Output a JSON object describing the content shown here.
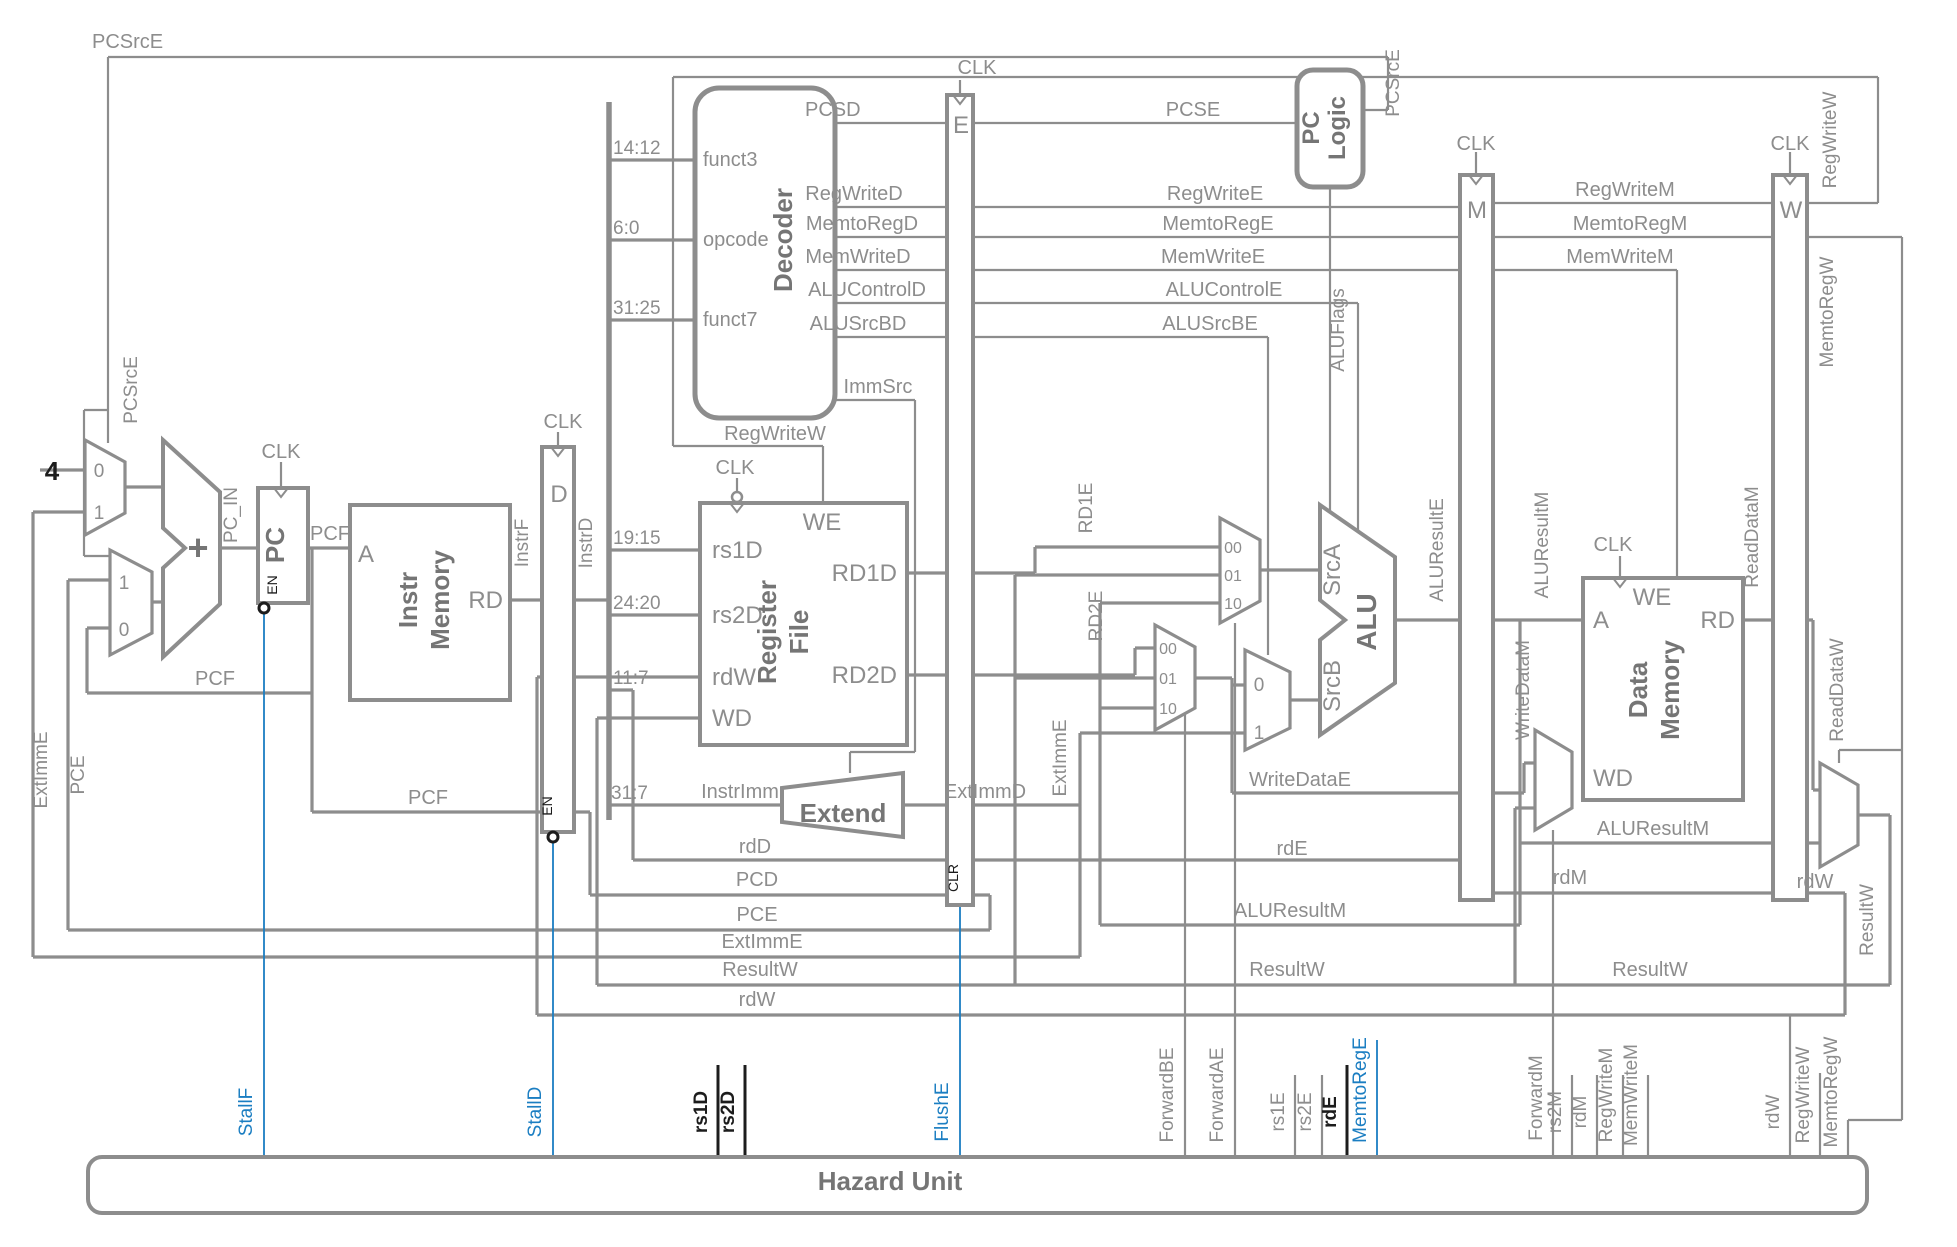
{
  "diagram": {
    "type": "pipelined-processor-schematic",
    "colors": {
      "wire_gray": "#8d8d8d",
      "hazard_blue": "#1b7ec2",
      "signal_black": "#1c1c1c"
    },
    "labels": [
      {
        "n": "pcsrce-top-label",
        "t": "PCSrcE",
        "x": 92,
        "y": 48,
        "a": "start"
      },
      {
        "n": "clk-pc-label",
        "t": "CLK",
        "x": 281,
        "y": 458
      },
      {
        "n": "clk-d-label",
        "t": "CLK",
        "x": 563,
        "y": 428
      },
      {
        "n": "clk-regfile-label",
        "t": "CLK",
        "x": 735,
        "y": 474
      },
      {
        "n": "clk-e-label",
        "t": "CLK",
        "x": 977,
        "y": 74
      },
      {
        "n": "clk-m-label",
        "t": "CLK",
        "x": 1476,
        "y": 150
      },
      {
        "n": "clk-w-label",
        "t": "CLK",
        "x": 1790,
        "y": 150
      },
      {
        "n": "clk-dmem-label",
        "t": "CLK",
        "x": 1613,
        "y": 551
      },
      {
        "n": "const-four",
        "t": "4",
        "x": 52,
        "y": 480,
        "c": "black",
        "s": 26,
        "b": true
      },
      {
        "n": "mux-a-0",
        "t": "0",
        "x": 99,
        "y": 477,
        "s": 19
      },
      {
        "n": "mux-a-1",
        "t": "1",
        "x": 99,
        "y": 519,
        "s": 19
      },
      {
        "n": "mux-b-1",
        "t": "1",
        "x": 124,
        "y": 589,
        "s": 19
      },
      {
        "n": "mux-b-0",
        "t": "0",
        "x": 124,
        "y": 636,
        "s": 19
      },
      {
        "n": "adder-plus",
        "t": "+",
        "x": 198,
        "y": 560,
        "c": "dark",
        "s": 36,
        "b": true
      },
      {
        "n": "pc-in-label",
        "t": "PC_IN",
        "x": 237,
        "y": 515,
        "r": -90,
        "s": 19
      },
      {
        "n": "pc-title",
        "t": "PC",
        "x": 284,
        "y": 545,
        "r": -90,
        "c": "dark",
        "s": 26,
        "b": true
      },
      {
        "n": "pc-en-label",
        "t": "EN",
        "x": 277,
        "y": 585,
        "r": -90,
        "c": "black",
        "s": 14
      },
      {
        "n": "pcf-label-1",
        "t": "PCF",
        "x": 330,
        "y": 540
      },
      {
        "n": "imem-a-port",
        "t": "A",
        "x": 366,
        "y": 562,
        "s": 24
      },
      {
        "n": "imem-rd-port",
        "t": "RD",
        "x": 503,
        "y": 608,
        "s": 24,
        "a": "end"
      },
      {
        "n": "imem-title-1",
        "t": "Instr",
        "x": 417,
        "y": 600,
        "r": -90,
        "c": "dark",
        "s": 26,
        "b": true
      },
      {
        "n": "imem-title-2",
        "t": "Memory",
        "x": 449,
        "y": 600,
        "r": -90,
        "c": "dark",
        "s": 26,
        "b": true
      },
      {
        "n": "instrf-label",
        "t": "InstrF",
        "x": 528,
        "y": 543,
        "r": -90,
        "s": 19
      },
      {
        "n": "dreg-title",
        "t": "D",
        "x": 559,
        "y": 502,
        "s": 24
      },
      {
        "n": "instrd-label",
        "t": "InstrD",
        "x": 592,
        "y": 543,
        "r": -90,
        "s": 19
      },
      {
        "n": "d-en-label",
        "t": "EN",
        "x": 552,
        "y": 806,
        "r": -90,
        "c": "black",
        "s": 14
      },
      {
        "n": "pcf-label-2",
        "t": "PCF",
        "x": 215,
        "y": 685
      },
      {
        "n": "pcf-label-3",
        "t": "PCF",
        "x": 428,
        "y": 804
      },
      {
        "n": "bits-14-12",
        "t": "14:12",
        "x": 613,
        "y": 154,
        "a": "start",
        "s": 19
      },
      {
        "n": "bits-6-0",
        "t": "6:0",
        "x": 613,
        "y": 234,
        "a": "start",
        "s": 19
      },
      {
        "n": "bits-31-25",
        "t": "31:25",
        "x": 613,
        "y": 314,
        "a": "start",
        "s": 19
      },
      {
        "n": "bits-19-15",
        "t": "19:15",
        "x": 613,
        "y": 544,
        "a": "start",
        "s": 19
      },
      {
        "n": "bits-24-20",
        "t": "24:20",
        "x": 613,
        "y": 609,
        "a": "start",
        "s": 19
      },
      {
        "n": "bits-11-7",
        "t": "11:7",
        "x": 613,
        "y": 684,
        "a": "start",
        "s": 19
      },
      {
        "n": "bits-31-7",
        "t": "31:7",
        "x": 611,
        "y": 799,
        "a": "start",
        "s": 19
      },
      {
        "n": "funct3-port",
        "t": "funct3",
        "x": 703,
        "y": 166,
        "a": "start"
      },
      {
        "n": "opcode-port",
        "t": "opcode",
        "x": 703,
        "y": 246,
        "a": "start"
      },
      {
        "n": "funct7-port",
        "t": "funct7",
        "x": 703,
        "y": 326,
        "a": "start"
      },
      {
        "n": "decoder-title",
        "t": "Decoder",
        "x": 792,
        "y": 240,
        "r": -90,
        "c": "dark",
        "s": 26,
        "b": true
      },
      {
        "n": "pcsd-label",
        "t": "PCSD",
        "x": 805,
        "y": 116,
        "a": "start"
      },
      {
        "n": "regwrited-label",
        "t": "RegWriteD",
        "x": 854,
        "y": 200
      },
      {
        "n": "memtoregd-label",
        "t": "MemtoRegD",
        "x": 862,
        "y": 230
      },
      {
        "n": "memwrited-label",
        "t": "MemWriteD",
        "x": 858,
        "y": 263
      },
      {
        "n": "alucontrold-label",
        "t": "ALUControlD",
        "x": 867,
        "y": 296
      },
      {
        "n": "alusrcbd-label",
        "t": "ALUSrcBD",
        "x": 858,
        "y": 330
      },
      {
        "n": "immsrc-label",
        "t": "ImmSrc",
        "x": 878,
        "y": 393
      },
      {
        "n": "regwritew-mid-label",
        "t": "RegWriteW",
        "x": 775,
        "y": 440
      },
      {
        "n": "rf-we-port",
        "t": "WE",
        "x": 822,
        "y": 530,
        "s": 24
      },
      {
        "n": "rf-rs1d-port",
        "t": "rs1D",
        "x": 712,
        "y": 558,
        "a": "start",
        "s": 24
      },
      {
        "n": "rf-rs2d-port",
        "t": "rs2D",
        "x": 712,
        "y": 623,
        "a": "start",
        "s": 24
      },
      {
        "n": "rf-rdw-port",
        "t": "rdW",
        "x": 712,
        "y": 685,
        "a": "start",
        "s": 24
      },
      {
        "n": "rf-wd-port",
        "t": "WD",
        "x": 712,
        "y": 726,
        "a": "start",
        "s": 24
      },
      {
        "n": "rf-rd1d-port",
        "t": "RD1D",
        "x": 897,
        "y": 581,
        "a": "end",
        "s": 24
      },
      {
        "n": "rf-rd2d-port",
        "t": "RD2D",
        "x": 897,
        "y": 683,
        "a": "end",
        "s": 24
      },
      {
        "n": "rf-title-1",
        "t": "Register",
        "x": 776,
        "y": 632,
        "r": -90,
        "c": "dark",
        "s": 26,
        "b": true
      },
      {
        "n": "rf-title-2",
        "t": "File",
        "x": 808,
        "y": 632,
        "r": -90,
        "c": "dark",
        "s": 26,
        "b": true
      },
      {
        "n": "instrimm-label",
        "t": "InstrImm",
        "x": 740,
        "y": 798
      },
      {
        "n": "extend-title",
        "t": "Extend",
        "x": 843,
        "y": 822,
        "c": "dark",
        "s": 26,
        "b": true
      },
      {
        "n": "extimmd-label",
        "t": "ExtImmD",
        "x": 985,
        "y": 798
      },
      {
        "n": "ereg-title",
        "t": "E",
        "x": 961,
        "y": 133,
        "s": 24
      },
      {
        "n": "e-clr-label",
        "t": "CLR",
        "x": 958,
        "y": 878,
        "r": -90,
        "c": "black",
        "s": 14
      },
      {
        "n": "rd1e-label",
        "t": "RD1E",
        "x": 1092,
        "y": 508,
        "r": -90,
        "s": 19
      },
      {
        "n": "rd2e-label",
        "t": "RD2E",
        "x": 1102,
        "y": 616,
        "r": -90,
        "s": 19
      },
      {
        "n": "extimme-vert-label",
        "t": "ExtImmE",
        "x": 1066,
        "y": 758,
        "r": -90,
        "s": 19
      },
      {
        "n": "pcse-label",
        "t": "PCSE",
        "x": 1193,
        "y": 116
      },
      {
        "n": "regwritee-label",
        "t": "RegWriteE",
        "x": 1215,
        "y": 200
      },
      {
        "n": "memtorege-label",
        "t": "MemtoRegE",
        "x": 1218,
        "y": 230
      },
      {
        "n": "memwritee-label",
        "t": "MemWriteE",
        "x": 1213,
        "y": 263
      },
      {
        "n": "alucontrole-label",
        "t": "ALUControlE",
        "x": 1224,
        "y": 296
      },
      {
        "n": "alusrcbe-label",
        "t": "ALUSrcBE",
        "x": 1210,
        "y": 330
      },
      {
        "n": "aluflags-label",
        "t": "ALUFlags",
        "x": 1344,
        "y": 330,
        "r": -90,
        "s": 19
      },
      {
        "n": "fwda-00",
        "t": "00",
        "x": 1233,
        "y": 553,
        "s": 16
      },
      {
        "n": "fwda-01",
        "t": "01",
        "x": 1233,
        "y": 581,
        "s": 16
      },
      {
        "n": "fwda-10",
        "t": "10",
        "x": 1233,
        "y": 609,
        "s": 16
      },
      {
        "n": "fwdb-00",
        "t": "00",
        "x": 1168,
        "y": 654,
        "s": 16
      },
      {
        "n": "fwdb-01",
        "t": "01",
        "x": 1168,
        "y": 684,
        "s": 16
      },
      {
        "n": "fwdb-10",
        "t": "10",
        "x": 1168,
        "y": 714,
        "s": 16
      },
      {
        "n": "srcb-mux-0",
        "t": "0",
        "x": 1259,
        "y": 691,
        "s": 19
      },
      {
        "n": "srcb-mux-1",
        "t": "1",
        "x": 1259,
        "y": 739,
        "s": 19
      },
      {
        "n": "srca-port",
        "t": "SrcA",
        "x": 1340,
        "y": 570,
        "r": -90,
        "s": 24
      },
      {
        "n": "srcb-port",
        "t": "SrcB",
        "x": 1340,
        "y": 686,
        "r": -90,
        "s": 24
      },
      {
        "n": "alu-title",
        "t": "ALU",
        "x": 1376,
        "y": 622,
        "r": -90,
        "c": "dark",
        "s": 28,
        "b": true
      },
      {
        "n": "aluresulte-label",
        "t": "ALUResultE",
        "x": 1443,
        "y": 550,
        "r": -90,
        "s": 19
      },
      {
        "n": "pclogic-title-1",
        "t": "PC",
        "x": 1319,
        "y": 128,
        "r": -90,
        "c": "dark",
        "s": 24,
        "b": true
      },
      {
        "n": "pclogic-title-2",
        "t": "Logic",
        "x": 1345,
        "y": 128,
        "r": -90,
        "c": "dark",
        "s": 24,
        "b": true
      },
      {
        "n": "pcsrce-right-label",
        "t": "PCSrcE",
        "x": 1399,
        "y": 83,
        "r": -90,
        "s": 19
      },
      {
        "n": "mreg-title",
        "t": "M",
        "x": 1477,
        "y": 218,
        "s": 24
      },
      {
        "n": "wreg-title",
        "t": "W",
        "x": 1791,
        "y": 218,
        "s": 24
      },
      {
        "n": "regwritem-label",
        "t": "RegWriteM",
        "x": 1625,
        "y": 196
      },
      {
        "n": "memtoregm-label",
        "t": "MemtoRegM",
        "x": 1630,
        "y": 230
      },
      {
        "n": "memwritem-label",
        "t": "MemWriteM",
        "x": 1620,
        "y": 263
      },
      {
        "n": "regwritew-right-label",
        "t": "RegWriteW",
        "x": 1836,
        "y": 140,
        "r": -90,
        "s": 19
      },
      {
        "n": "memtoregw-right-label",
        "t": "MemtoRegW",
        "x": 1833,
        "y": 312,
        "r": -90,
        "s": 19
      },
      {
        "n": "aluresultm-vert-label",
        "t": "ALUResultM",
        "x": 1548,
        "y": 545,
        "r": -90,
        "s": 19
      },
      {
        "n": "writedatam-vert-label",
        "t": "WriteDataM",
        "x": 1529,
        "y": 690,
        "r": -90,
        "s": 19
      },
      {
        "n": "readdatam-vert-label",
        "t": "ReadDataM",
        "x": 1758,
        "y": 537,
        "r": -90,
        "s": 19
      },
      {
        "n": "readdataw-vert-label",
        "t": "ReadDataW",
        "x": 1843,
        "y": 690,
        "r": -90,
        "s": 19
      },
      {
        "n": "dmem-we-port",
        "t": "WE",
        "x": 1652,
        "y": 605,
        "s": 24
      },
      {
        "n": "dmem-a-port",
        "t": "A",
        "x": 1593,
        "y": 628,
        "a": "start",
        "s": 24
      },
      {
        "n": "dmem-rd-port",
        "t": "RD",
        "x": 1735,
        "y": 628,
        "a": "end",
        "s": 24
      },
      {
        "n": "dmem-wd-port",
        "t": "WD",
        "x": 1593,
        "y": 786,
        "a": "start",
        "s": 24
      },
      {
        "n": "dmem-title-1",
        "t": "Data",
        "x": 1647,
        "y": 690,
        "r": -90,
        "c": "dark",
        "s": 26,
        "b": true
      },
      {
        "n": "dmem-title-2",
        "t": "Memory",
        "x": 1679,
        "y": 690,
        "r": -90,
        "c": "dark",
        "s": 26,
        "b": true
      },
      {
        "n": "writedatae-label",
        "t": "WriteDataE",
        "x": 1300,
        "y": 786
      },
      {
        "n": "rde-line-label",
        "t": "rdE",
        "x": 1292,
        "y": 855
      },
      {
        "n": "aluresultm-line-label-1",
        "t": "ALUResultM",
        "x": 1290,
        "y": 917
      },
      {
        "n": "resultw-line-label-1",
        "t": "ResultW",
        "x": 1287,
        "y": 976
      },
      {
        "n": "aluresultm-line-label-2",
        "t": "ALUResultM",
        "x": 1653,
        "y": 835
      },
      {
        "n": "rdm-line-label",
        "t": "rdM",
        "x": 1570,
        "y": 884
      },
      {
        "n": "resultw-line-label-2",
        "t": "ResultW",
        "x": 1650,
        "y": 976
      },
      {
        "n": "rdw-right-label",
        "t": "rdW",
        "x": 1815,
        "y": 888
      },
      {
        "n": "resultw-vert-label",
        "t": "ResultW",
        "x": 1873,
        "y": 920,
        "r": -90,
        "s": 19
      },
      {
        "n": "rdd-line-label",
        "t": "rdD",
        "x": 755,
        "y": 853
      },
      {
        "n": "pcd-line-label",
        "t": "PCD",
        "x": 757,
        "y": 886
      },
      {
        "n": "pce-line-label",
        "t": "PCE",
        "x": 757,
        "y": 921
      },
      {
        "n": "extimme-line-label",
        "t": "ExtImmE",
        "x": 762,
        "y": 948
      },
      {
        "n": "resultw-line-label-0",
        "t": "ResultW",
        "x": 760,
        "y": 976
      },
      {
        "n": "rdw-line-label-0",
        "t": "rdW",
        "x": 757,
        "y": 1006
      },
      {
        "n": "pcsrce-left-vert-label",
        "t": "PCSrcE",
        "x": 137,
        "y": 390,
        "r": -90,
        "s": 19
      },
      {
        "n": "extimme-left-vert-label",
        "t": "ExtImmE",
        "x": 47,
        "y": 770,
        "r": -90,
        "s": 19
      },
      {
        "n": "pce-left-vert-label",
        "t": "PCE",
        "x": 84,
        "y": 775,
        "r": -90,
        "s": 19
      },
      {
        "n": "hazard-title",
        "t": "Hazard Unit",
        "x": 890,
        "y": 1190,
        "c": "dark",
        "s": 26,
        "b": true
      },
      {
        "n": "stallf-label",
        "t": "StallF",
        "x": 252,
        "y": 1112,
        "r": -90,
        "c": "blue",
        "s": 19
      },
      {
        "n": "stalld-label",
        "t": "StallD",
        "x": 541,
        "y": 1112,
        "r": -90,
        "c": "blue",
        "s": 19
      },
      {
        "n": "rs1d-hazard-label",
        "t": "rs1D",
        "x": 707,
        "y": 1112,
        "r": -90,
        "c": "black",
        "s": 19,
        "b": true
      },
      {
        "n": "rs2d-hazard-label",
        "t": "rs2D",
        "x": 734,
        "y": 1112,
        "r": -90,
        "c": "black",
        "s": 19,
        "b": true
      },
      {
        "n": "flushe-label",
        "t": "FlushE",
        "x": 948,
        "y": 1112,
        "r": -90,
        "c": "blue",
        "s": 19
      },
      {
        "n": "forwardbe-label",
        "t": "ForwardBE",
        "x": 1173,
        "y": 1095,
        "r": -90,
        "s": 19
      },
      {
        "n": "forwardae-label",
        "t": "ForwardAE",
        "x": 1223,
        "y": 1095,
        "r": -90,
        "s": 19
      },
      {
        "n": "rs1e-hazard-label",
        "t": "rs1E",
        "x": 1284,
        "y": 1112,
        "r": -90,
        "s": 19
      },
      {
        "n": "rs2e-hazard-label",
        "t": "rs2E",
        "x": 1311,
        "y": 1112,
        "r": -90,
        "s": 19
      },
      {
        "n": "rde-hazard-label",
        "t": "rdE",
        "x": 1336,
        "y": 1112,
        "r": -90,
        "c": "black",
        "s": 19,
        "b": true
      },
      {
        "n": "memtorege-hazard-label",
        "t": "MemtoRegE",
        "x": 1366,
        "y": 1090,
        "r": -90,
        "c": "blue",
        "s": 19
      },
      {
        "n": "forwardm-label",
        "t": "ForwardM",
        "x": 1542,
        "y": 1098,
        "r": -90,
        "s": 19
      },
      {
        "n": "rs2m-hazard-label",
        "t": "rs2M",
        "x": 1561,
        "y": 1112,
        "r": -90,
        "s": 19
      },
      {
        "n": "rdm-hazard-label",
        "t": "rdM",
        "x": 1586,
        "y": 1112,
        "r": -90,
        "s": 19
      },
      {
        "n": "regwritem-hazard-label",
        "t": "RegWriteM",
        "x": 1612,
        "y": 1095,
        "r": -90,
        "s": 19
      },
      {
        "n": "memwritem-hazard-label",
        "t": "MemWriteM",
        "x": 1637,
        "y": 1095,
        "r": -90,
        "s": 19
      },
      {
        "n": "rdw-hazard-label",
        "t": "rdW",
        "x": 1779,
        "y": 1112,
        "r": -90,
        "s": 19
      },
      {
        "n": "regwritew-hazard-label",
        "t": "RegWriteW",
        "x": 1809,
        "y": 1095,
        "r": -90,
        "s": 19
      },
      {
        "n": "memtoregw-hazard-label",
        "t": "MemtoRegW",
        "x": 1837,
        "y": 1092,
        "r": -90,
        "s": 19
      }
    ]
  }
}
